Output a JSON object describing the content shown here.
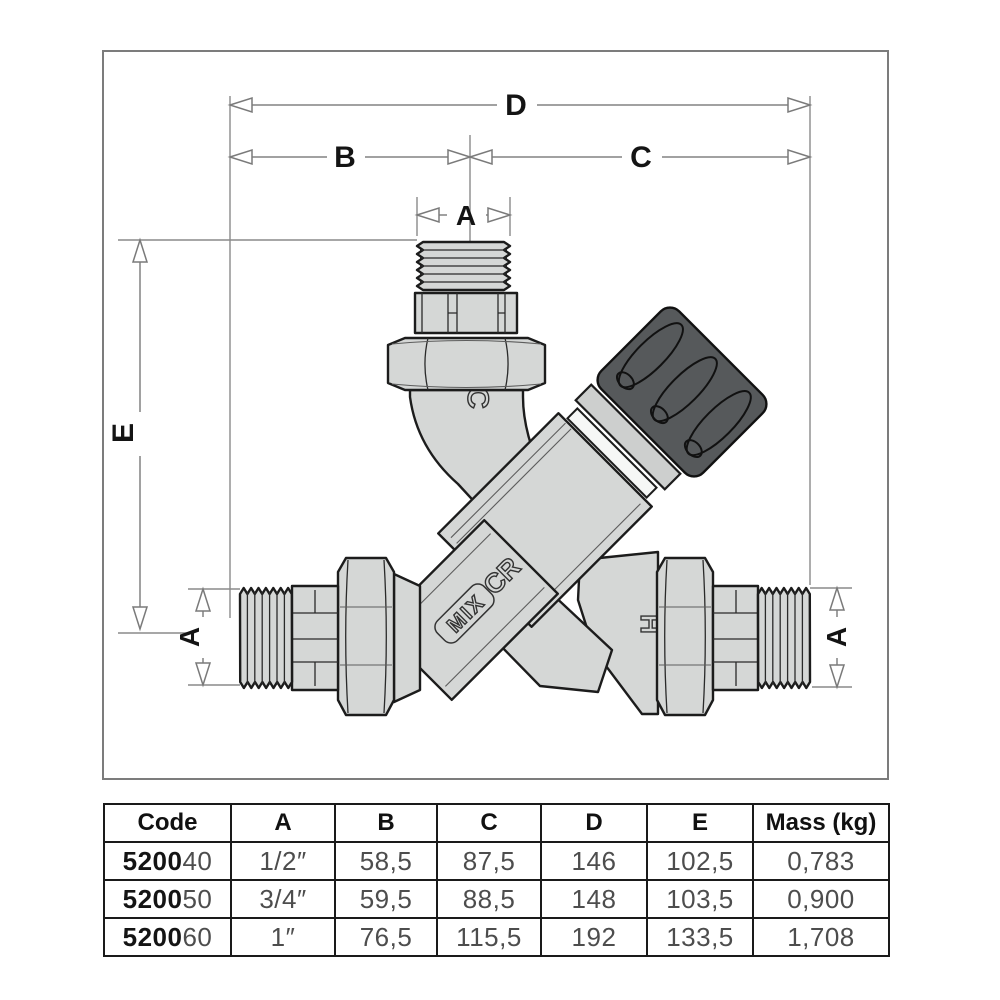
{
  "figure": {
    "dimension_labels": {
      "D": "D",
      "B": "B",
      "C": "C",
      "A": "A",
      "E": "E"
    },
    "body_markings": {
      "cold": "C",
      "brand": "CR",
      "mix": "MIX",
      "hot": "H"
    }
  },
  "table": {
    "headers": [
      "Code",
      "A",
      "B",
      "C",
      "D",
      "E",
      "Mass (kg)"
    ],
    "rows": [
      {
        "code_prefix": "5200",
        "code_suffix": "40",
        "a": "1/2″",
        "b": "58,5",
        "c": "87,5",
        "d": "146",
        "e": "102,5",
        "mass": "0,783"
      },
      {
        "code_prefix": "5200",
        "code_suffix": "50",
        "a": "3/4″",
        "b": "59,5",
        "c": "88,5",
        "d": "148",
        "e": "103,5",
        "mass": "0,900"
      },
      {
        "code_prefix": "5200",
        "code_suffix": "60",
        "a": "1″",
        "b": "76,5",
        "c": "115,5",
        "d": "192",
        "e": "133,5",
        "mass": "1,708"
      }
    ]
  },
  "colors": {
    "accent_metal": "#d5d7d6",
    "knob": "#56595b",
    "line": "#1c1c1c",
    "dim_line": "#828282"
  }
}
